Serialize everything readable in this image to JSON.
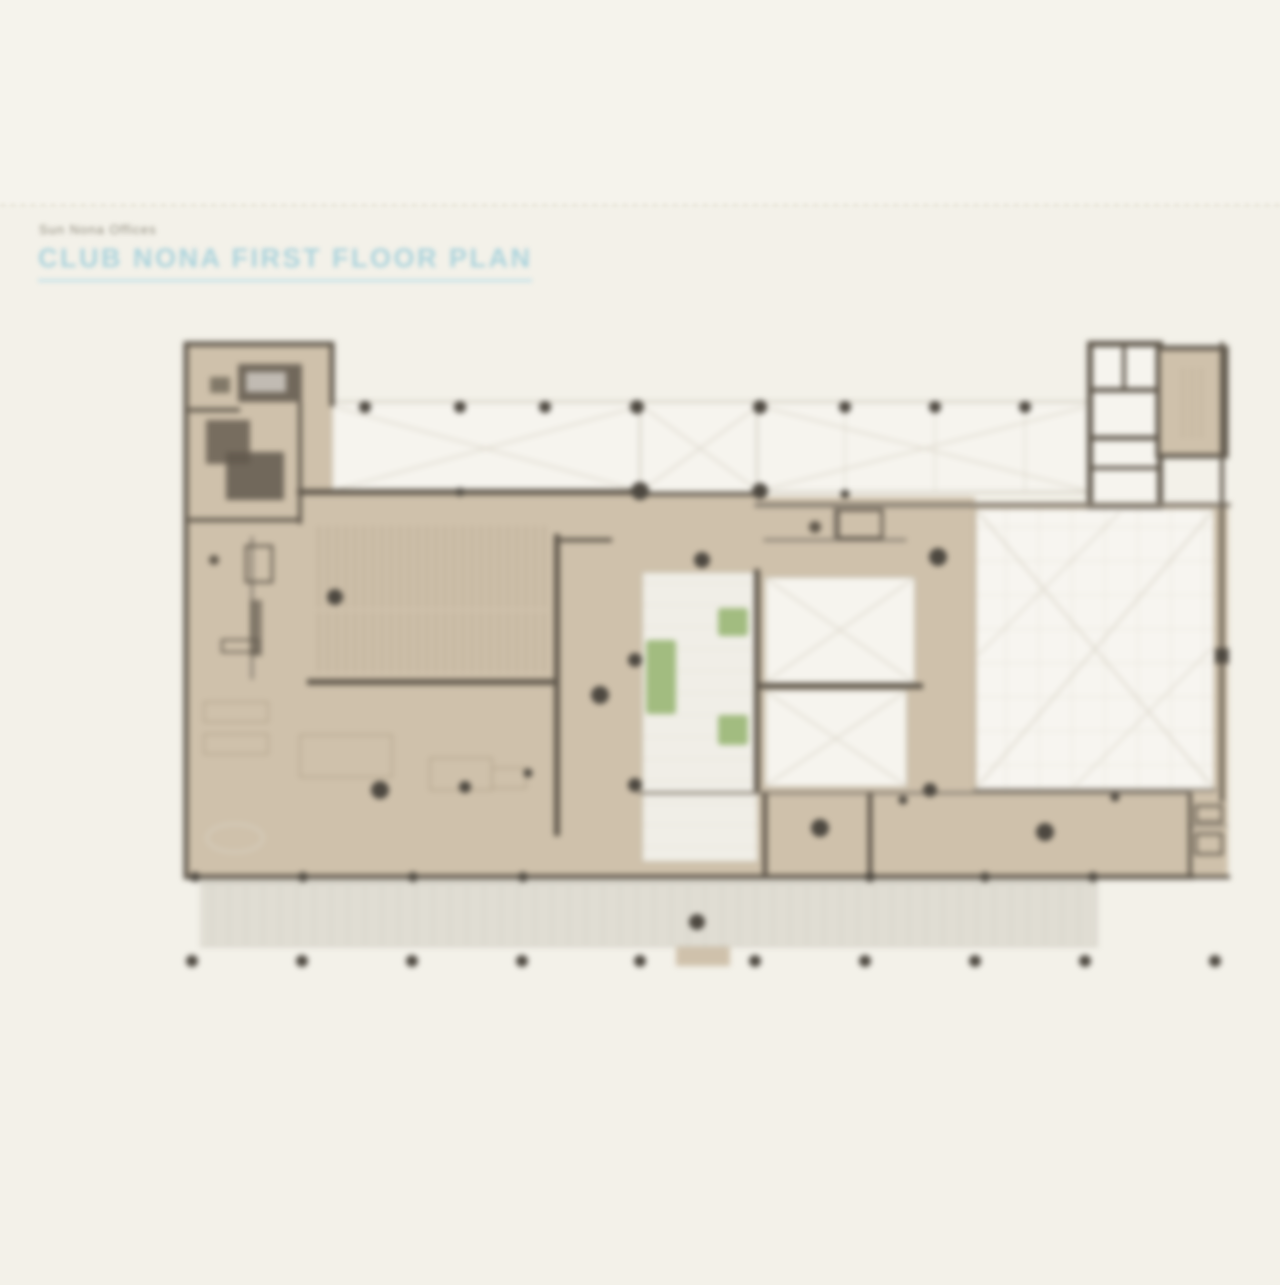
{
  "page": {
    "eyebrow": "Sun Nona Offices",
    "title": "CLUB NONA FIRST FLOOR PLAN"
  },
  "figure": {
    "label": "first-floor-plan-drawing"
  },
  "palette": {
    "page-bg": "#f3f1e9",
    "page-bg-top": "#f5f3ec",
    "separator": "#e6e3d5",
    "eyebrow-gray": "#8f8b7d",
    "title-blue": "#abd3dc",
    "title-underline": "#c6e2e9",
    "floor-tan": "#cfc1ab",
    "room-white": "#f6f4ee",
    "court-white": "#f0eee7",
    "terrace-gray": "#e0ddd3",
    "planter-green": "#a2bc80",
    "wall-dark": "#60584c",
    "wall-mid": "#8a8174",
    "line-faint": "#d9d4c7",
    "grid-faint": "#e6e2d6",
    "column-dark": "#4d4840"
  }
}
